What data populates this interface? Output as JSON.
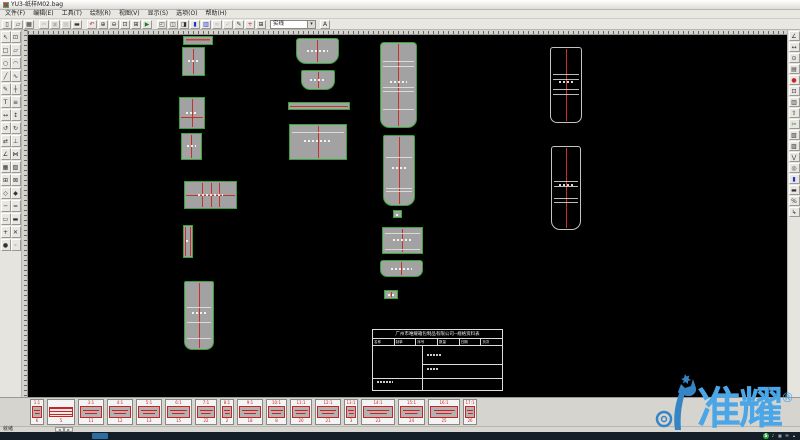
{
  "window": {
    "title": "YU3-纸样M02.bag",
    "status": "就绪"
  },
  "menu": {
    "items": [
      "文件(F)",
      "编辑(E)",
      "工具(T)",
      "绘制(R)",
      "视图(V)",
      "显示(S)",
      "选项(O)",
      "帮助(H)"
    ]
  },
  "toolbar": {
    "combo_value": "实线",
    "end_icon": {
      "name": "text-style-icon",
      "glyph": "A"
    },
    "icons": [
      {
        "name": "new-icon",
        "glyph": "▯"
      },
      {
        "name": "open-icon",
        "glyph": "▱"
      },
      {
        "name": "save-icon",
        "glyph": "▦"
      },
      {
        "sep": true
      },
      {
        "name": "cut-icon",
        "glyph": "✂",
        "dim": true
      },
      {
        "name": "copy-icon",
        "glyph": "▣",
        "dim": true
      },
      {
        "name": "paste-icon",
        "glyph": "▤",
        "dim": true
      },
      {
        "name": "print-icon",
        "glyph": "▬"
      },
      {
        "sep": true
      },
      {
        "name": "undo-icon",
        "glyph": "↶",
        "color": "#c22"
      },
      {
        "name": "zoom-in-icon",
        "glyph": "⊕"
      },
      {
        "name": "zoom-out-icon",
        "glyph": "⊖"
      },
      {
        "name": "zoom-window-icon",
        "glyph": "⊡"
      },
      {
        "name": "zoom-all-icon",
        "glyph": "⊞"
      },
      {
        "name": "redraw-icon",
        "glyph": "▶",
        "color": "#2a7a2a"
      },
      {
        "sep": true
      },
      {
        "name": "window-cascade-icon",
        "glyph": "◰"
      },
      {
        "name": "window-tile-icon",
        "glyph": "◫"
      },
      {
        "name": "window-split-icon",
        "glyph": "◨"
      },
      {
        "name": "fill-color-icon",
        "glyph": "▮",
        "color": "#2233cc"
      },
      {
        "name": "layer-icon",
        "glyph": "▥",
        "color": "#2233cc"
      },
      {
        "name": "link-icon",
        "glyph": "∞",
        "dim": true
      },
      {
        "name": "check-icon",
        "glyph": "✓",
        "dim": true
      },
      {
        "name": "edit-icon",
        "glyph": "✎"
      },
      {
        "name": "add-icon",
        "glyph": "+",
        "color": "#c22"
      },
      {
        "name": "table-icon",
        "glyph": "⊞"
      }
    ]
  },
  "left_toolbar": {
    "icons": [
      {
        "name": "select-icon",
        "glyph": "↖"
      },
      {
        "name": "zoom-box-icon",
        "glyph": "⊡"
      },
      {
        "name": "rect-icon",
        "glyph": "□"
      },
      {
        "name": "polygon-icon",
        "glyph": "▱"
      },
      {
        "name": "circle-icon",
        "glyph": "○"
      },
      {
        "name": "arc-icon",
        "glyph": "◠"
      },
      {
        "name": "line-icon",
        "glyph": "╱"
      },
      {
        "name": "curve-icon",
        "glyph": "∿"
      },
      {
        "name": "pencil-icon",
        "glyph": "✎"
      },
      {
        "name": "cross-icon",
        "glyph": "┼"
      },
      {
        "name": "text-icon",
        "glyph": "T"
      },
      {
        "name": "hatch-icon",
        "glyph": "≡"
      },
      {
        "name": "move-icon",
        "glyph": "↔"
      },
      {
        "name": "stretch-icon",
        "glyph": "↕"
      },
      {
        "name": "rotate-ccw-icon",
        "glyph": "↺"
      },
      {
        "name": "rotate-cw-icon",
        "glyph": "↻"
      },
      {
        "name": "mirror-icon",
        "glyph": "⇄"
      },
      {
        "name": "perpendicular-icon",
        "glyph": "⊥"
      },
      {
        "name": "angle-icon",
        "glyph": "∠"
      },
      {
        "name": "join-icon",
        "glyph": "⋈"
      },
      {
        "name": "grid-icon",
        "glyph": "▦"
      },
      {
        "name": "pattern-icon",
        "glyph": "▧"
      },
      {
        "name": "table-grid-icon",
        "glyph": "⊞"
      },
      {
        "name": "delete-icon",
        "glyph": "⊠"
      },
      {
        "name": "diamond-icon",
        "glyph": "◇"
      },
      {
        "name": "solid-diamond-icon",
        "glyph": "◆"
      },
      {
        "name": "hline-icon",
        "glyph": "─"
      },
      {
        "name": "dline-icon",
        "glyph": "═"
      },
      {
        "name": "bar-icon",
        "glyph": "▭"
      },
      {
        "name": "solid-bar-icon",
        "glyph": "▬"
      },
      {
        "name": "plus-icon",
        "glyph": "+"
      },
      {
        "name": "close-icon",
        "glyph": "✕"
      },
      {
        "name": "point-icon",
        "glyph": "●"
      },
      {
        "name": "node-icon",
        "glyph": "◦"
      }
    ]
  },
  "right_toolbar": {
    "icons": [
      {
        "name": "measure-icon",
        "glyph": "∠"
      },
      {
        "name": "dimension-icon",
        "glyph": "↔"
      },
      {
        "name": "circle-dim-icon",
        "glyph": "⊙"
      },
      {
        "name": "note-icon",
        "glyph": "▤"
      },
      {
        "name": "mark-icon",
        "glyph": "●",
        "color": "#c22"
      },
      {
        "name": "frame-icon",
        "glyph": "⊡"
      },
      {
        "name": "piece-list-icon",
        "glyph": "▥"
      },
      {
        "name": "export-icon",
        "glyph": "⇧"
      },
      {
        "name": "cut-piece-icon",
        "glyph": "✂",
        "color": "#2a7a2a"
      },
      {
        "name": "seam-icon",
        "glyph": "▧"
      },
      {
        "name": "grade-icon",
        "glyph": "▨"
      },
      {
        "name": "notch-icon",
        "glyph": "⋁"
      },
      {
        "name": "punch-icon",
        "glyph": "◎"
      },
      {
        "name": "fill-icon",
        "glyph": "▮",
        "color": "#2233cc"
      },
      {
        "name": "printer-icon",
        "glyph": "▬"
      },
      {
        "name": "scale-icon",
        "glyph": "%"
      },
      {
        "name": "arrow-out-icon",
        "glyph": "↳"
      }
    ]
  },
  "canvas": {
    "pieces": [
      {
        "name": "piece-strip-a",
        "x": 155,
        "y": 1,
        "w": 30,
        "h": 9,
        "kind": "filled",
        "redtext": true
      },
      {
        "name": "piece-b",
        "x": 154,
        "y": 12,
        "w": 23,
        "h": 29,
        "kind": "filled",
        "vlines": [
          0.5
        ],
        "dots": true
      },
      {
        "name": "piece-c",
        "x": 151,
        "y": 62,
        "w": 26,
        "h": 32,
        "kind": "filled",
        "vlines": [
          0.5
        ],
        "hlines": [
          0.62
        ],
        "dots": true
      },
      {
        "name": "piece-d",
        "x": 153,
        "y": 98,
        "w": 21,
        "h": 27,
        "kind": "filled",
        "vlines": [
          0.5
        ],
        "dots": true
      },
      {
        "name": "piece-e",
        "x": 156,
        "y": 146,
        "w": 53,
        "h": 28,
        "kind": "filled",
        "vlines": [
          0.35,
          0.52,
          0.68
        ],
        "hlines": [
          0.5
        ],
        "dots": true
      },
      {
        "name": "piece-f",
        "x": 155,
        "y": 190,
        "w": 10,
        "h": 33,
        "kind": "filled",
        "vlines": [
          0.18,
          0.82
        ],
        "dots": true
      },
      {
        "name": "piece-g",
        "x": 156,
        "y": 246,
        "w": 30,
        "h": 69,
        "kind": "filled",
        "r": "2px 2px 8px 8px",
        "vlines": [
          0.5
        ],
        "wlines": [
          0.38,
          0.6,
          0.84
        ],
        "dots": true
      },
      {
        "name": "piece-h",
        "x": 268,
        "y": 3,
        "w": 43,
        "h": 26,
        "kind": "filled",
        "r": "3px 3px 10px 10px",
        "vlines": [
          0.5
        ],
        "dots": true
      },
      {
        "name": "piece-i",
        "x": 273,
        "y": 35,
        "w": 34,
        "h": 20,
        "kind": "filled",
        "r": "2px 2px 9px 9px",
        "vlines": [
          0.5
        ],
        "dots": true
      },
      {
        "name": "piece-j",
        "x": 260,
        "y": 67,
        "w": 62,
        "h": 8,
        "kind": "filled",
        "hlines": [
          0.5
        ]
      },
      {
        "name": "piece-k",
        "x": 261,
        "y": 89,
        "w": 58,
        "h": 36,
        "kind": "filled",
        "vlines": [
          0.5
        ],
        "wlines": [
          0.2
        ],
        "dots": true
      },
      {
        "name": "piece-l",
        "x": 352,
        "y": 7,
        "w": 37,
        "h": 86,
        "kind": "filled",
        "r": "4px 4px 9px 9px",
        "vlines": [
          0.5
        ],
        "wlines": [
          0.22,
          0.27,
          0.52,
          0.57,
          0.78
        ],
        "dots": true
      },
      {
        "name": "piece-m",
        "x": 355,
        "y": 100,
        "w": 32,
        "h": 71,
        "kind": "filled",
        "r": "2px 2px 9px 9px",
        "vlines": [
          0.5
        ],
        "wlines": [
          0.3,
          0.75,
          0.8
        ],
        "dots": true
      },
      {
        "name": "piece-q",
        "x": 365,
        "y": 175,
        "w": 9,
        "h": 8,
        "kind": "filled",
        "dots": true
      },
      {
        "name": "piece-n",
        "x": 354,
        "y": 192,
        "w": 41,
        "h": 27,
        "kind": "filled",
        "vlines": [
          0.5
        ],
        "wlines": [
          0.18,
          0.85
        ],
        "dots": true
      },
      {
        "name": "piece-o",
        "x": 352,
        "y": 225,
        "w": 43,
        "h": 17,
        "kind": "filled",
        "r": "3px 3px 7px 7px",
        "vlines": [
          0.5
        ],
        "dots": true
      },
      {
        "name": "piece-p",
        "x": 356,
        "y": 255,
        "w": 14,
        "h": 9,
        "kind": "filled",
        "vlines": [
          0.5
        ],
        "dots": true
      },
      {
        "name": "piece-r",
        "x": 522,
        "y": 12,
        "w": 32,
        "h": 76,
        "kind": "outline",
        "r": "3px 3px 7px 7px",
        "vlines": [
          0.5
        ],
        "wlines": [
          0.35,
          0.42,
          0.55,
          0.62
        ],
        "dots": true
      },
      {
        "name": "piece-s",
        "x": 523,
        "y": 111,
        "w": 30,
        "h": 84,
        "kind": "outline",
        "r": "3px 3px 9px 9px",
        "vlines": [
          0.5
        ],
        "wlines": [
          0.42,
          0.47,
          0.62,
          0.67
        ],
        "dots": true
      }
    ],
    "title_block": {
      "header": "广州市唯耀箱包制品有限公司--规格资料表",
      "cols": [
        "名称",
        "制单",
        "序号",
        "数量",
        "日期",
        "页次"
      ]
    }
  },
  "thumbstrip": {
    "items": [
      {
        "scale": "1:1",
        "num": "6",
        "w": 14
      },
      {
        "scale": "",
        "num": "5",
        "w": 28,
        "kind": "sheet"
      },
      {
        "scale": "3:1",
        "num": "11",
        "w": 26
      },
      {
        "scale": "4:1",
        "num": "12",
        "w": 26
      },
      {
        "scale": "5:1",
        "num": "13",
        "w": 26
      },
      {
        "scale": "6:1",
        "num": "15",
        "w": 27
      },
      {
        "scale": "7:1",
        "num": "22",
        "w": 22
      },
      {
        "scale": "8:1",
        "num": "2",
        "w": 14
      },
      {
        "scale": "9:1",
        "num": "18",
        "w": 26
      },
      {
        "scale": "10:1",
        "num": "8",
        "w": 21
      },
      {
        "scale": "11:1",
        "num": "20",
        "w": 22
      },
      {
        "scale": "12:1",
        "num": "21",
        "w": 26
      },
      {
        "scale": "13:1",
        "num": "3",
        "w": 14
      },
      {
        "scale": "14:1",
        "num": "23",
        "w": 34
      },
      {
        "scale": "15:1",
        "num": "24",
        "w": 27
      },
      {
        "scale": "16:1",
        "num": "25",
        "w": 32
      },
      {
        "scale": "17:1",
        "num": "26",
        "w": 14
      }
    ]
  },
  "taskbar": {
    "tray": [
      {
        "name": "tray-input-icon",
        "glyph": "S",
        "green": true
      },
      {
        "name": "tray-volume-icon",
        "glyph": "♪"
      },
      {
        "name": "tray-network-icon",
        "glyph": "▦"
      },
      {
        "name": "tray-message-icon",
        "glyph": "✉"
      },
      {
        "name": "tray-arrow-icon",
        "glyph": "▴"
      }
    ]
  },
  "watermark": {
    "text": "准耀",
    "reg": "®"
  },
  "colors": {
    "accent_blue": "#4aa6e6",
    "piece_green": "#35a535",
    "line_red": "#c9302c",
    "taskbar_navy": "#141e29"
  }
}
